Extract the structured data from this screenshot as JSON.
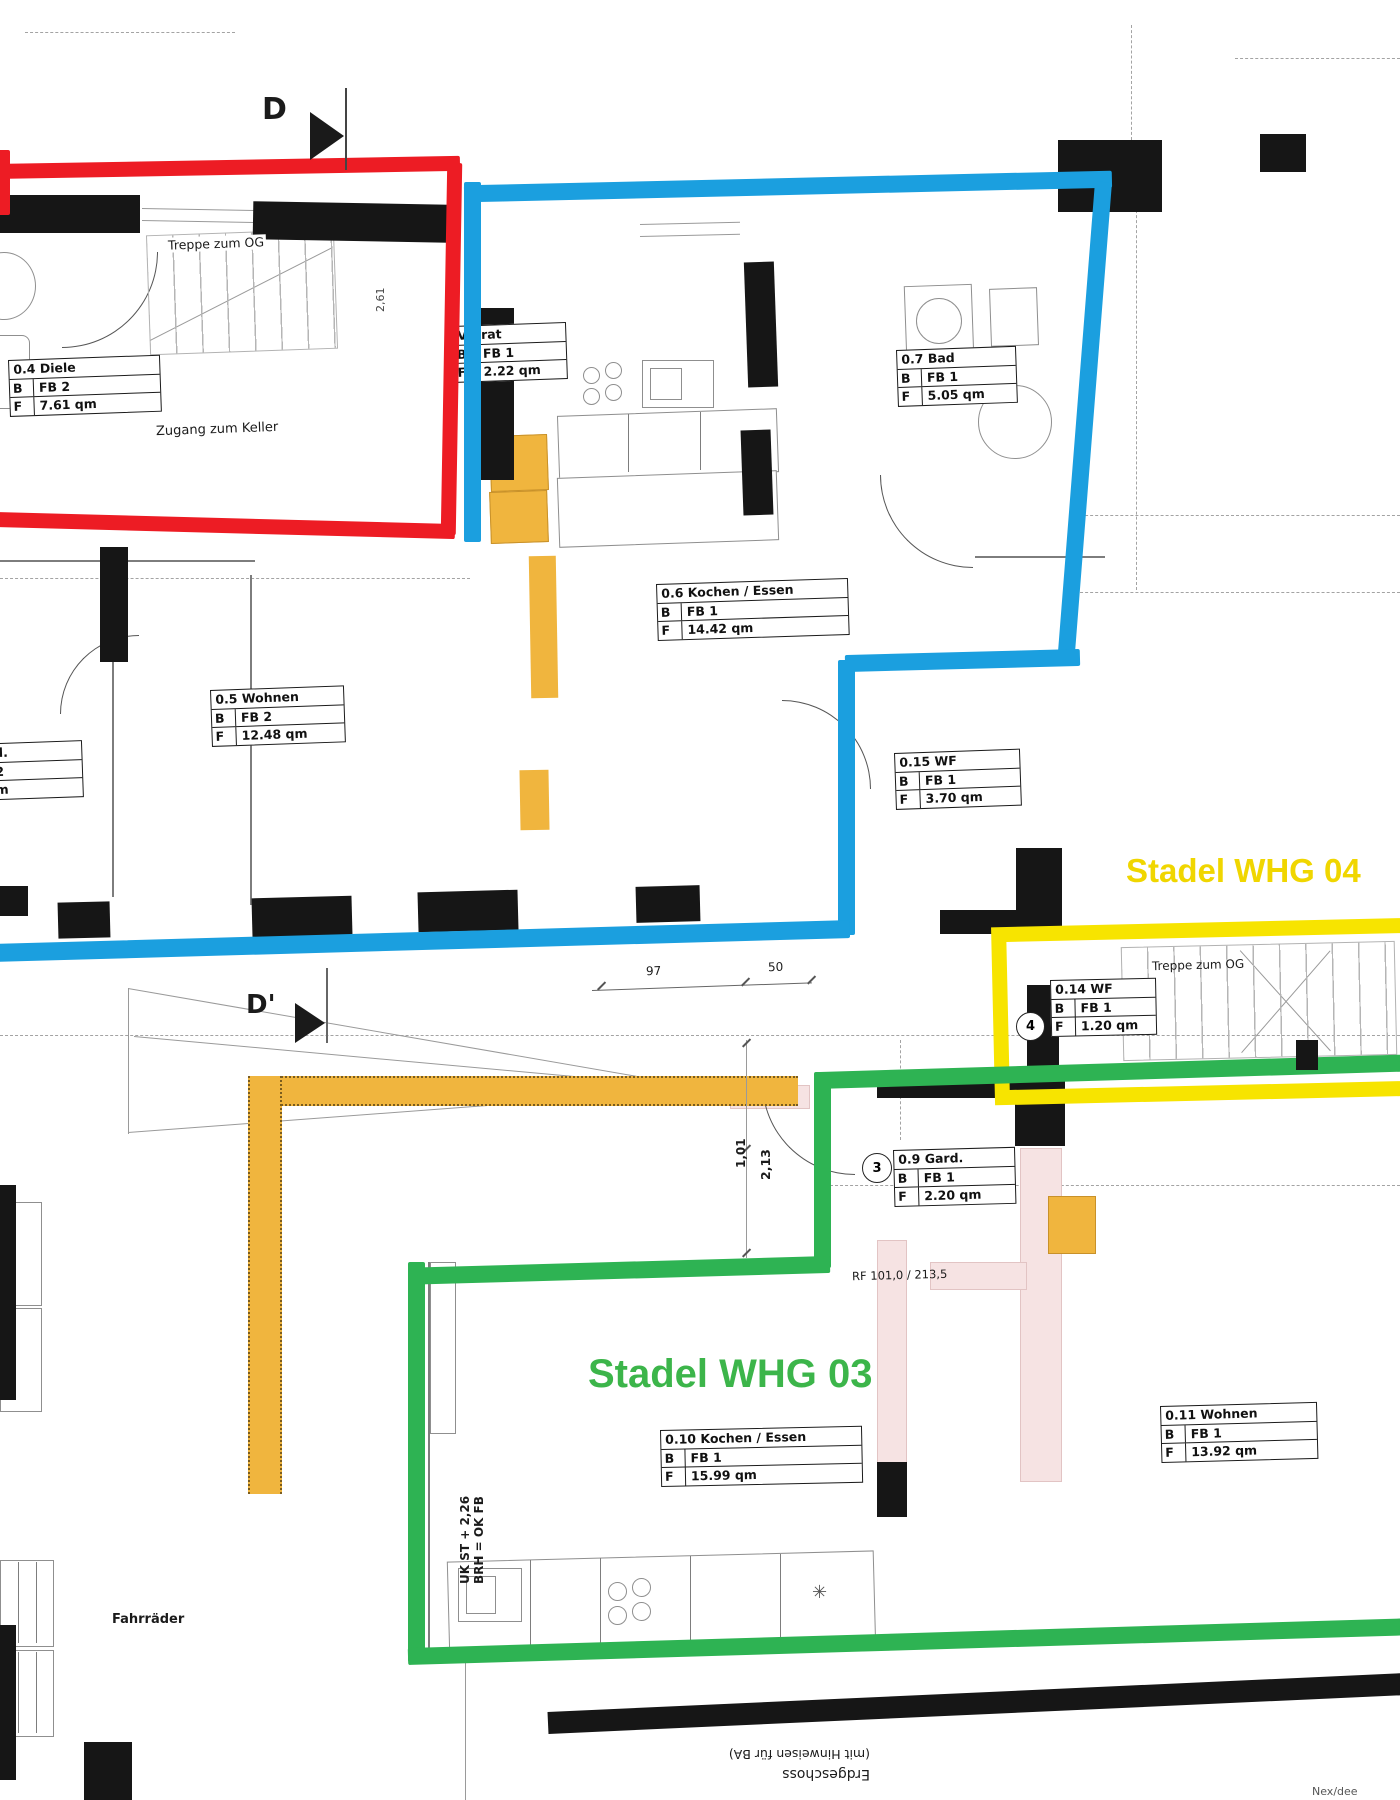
{
  "colors": {
    "red_outline": "#ed1c24",
    "blue_outline": "#1b9fdf",
    "yellow_outline": "#f7e400",
    "green_outline": "#2eb353",
    "yellow_text": "#f0d600",
    "green_text": "#3cb54a",
    "orange_fill": "#f0b53e",
    "pink_fill": "#f6e3e3",
    "wall": "#161616"
  },
  "apartments": [
    {
      "id": "whg04",
      "label": "Stadel WHG 04"
    },
    {
      "id": "whg03",
      "label": "Stadel WHG 03"
    }
  ],
  "sections": {
    "d": "D",
    "d_prime": "D'"
  },
  "table_labels": {
    "b": "B",
    "f": "F"
  },
  "rooms": [
    {
      "name": "0.4 Diele",
      "b": "FB 2",
      "f": "7.61 qm"
    },
    {
      "name": "Vorrat",
      "b": "FB 1",
      "f": "2.22 qm"
    },
    {
      "name": "0.6 Kochen / Essen",
      "b": "FB 1",
      "f": "14.42 qm"
    },
    {
      "name": "0.7 Bad",
      "b": "FB 1",
      "f": "5.05 qm"
    },
    {
      "name": "0.5 Wohnen",
      "b": "FB 2",
      "f": "12.48 qm"
    },
    {
      "name": "7 / Gard.",
      "b": "FB 2",
      "f": "3 qm"
    },
    {
      "name": "0.15 WF",
      "b": "FB 1",
      "f": "3.70 qm"
    },
    {
      "name": "0.14 WF",
      "b": "FB 1",
      "f": "1.20 qm"
    },
    {
      "name": "0.9 Gard.",
      "b": "FB 1",
      "f": "2.20 qm"
    },
    {
      "name": "0.10 Kochen / Essen",
      "b": "FB 1",
      "f": "15.99 qm"
    },
    {
      "name": "0.11 Wohnen",
      "b": "FB 1",
      "f": "13.92 qm"
    }
  ],
  "badges": {
    "circle_3": "3",
    "circle_4": "4"
  },
  "annotations": {
    "treppe_og_top": "Treppe zum OG",
    "zugang_keller": "Zugang zum Keller",
    "treppe_og_yellow": "Treppe zum OG",
    "rf_line": "RF 101,0 / 213,5",
    "dim_97": "97",
    "dim_50": "50",
    "dim_101": "1,01",
    "dim_213": "2,13",
    "dim_261": "2,61",
    "uk_line1": "UK ST + 2,26",
    "uk_line2": "BRH = OK FB",
    "fahrraeder": "Fahrräder",
    "floor_line1": "Erdgeschoss",
    "floor_line2": "(mit Hinweisen für BA)",
    "corner_note": "Nex/dee",
    "star_symbol": "✳"
  }
}
